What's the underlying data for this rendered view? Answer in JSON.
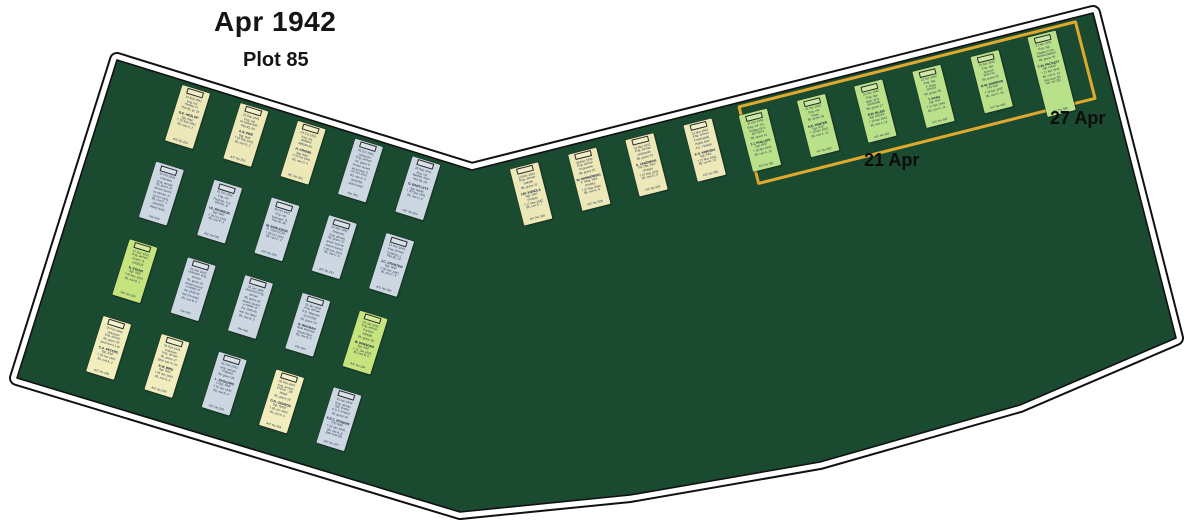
{
  "title": "Apr 1942",
  "subtitle": "Plot 85",
  "labels": {
    "apr21": "21 Apr",
    "apr27": "27 Apr"
  },
  "colors": {
    "felt": "#1a4a30",
    "outline": "#111111",
    "highlight_box": "#dfa92f",
    "card": {
      "cream": "#ece8b8",
      "blue": "#ccd7e2",
      "lime": "#c6e47d",
      "yellow": "#f1edbc",
      "green": "#b9e189"
    }
  },
  "left_grid": {
    "cards": [
      {
        "c": "cream",
        "t": [
          "15 Sep 1941",
          "Eng. mil.",
          "Heslop, D.",
          "Plot 85, gr. 19"
        ],
        "n": "G.E. HESLOP",
        "b": [
          "Sgt. RAF",
          "† 13 Sep 1941",
          "85, row D, 2"
        ],
        "r": "A/C No 251"
      },
      {
        "c": "cream",
        "t": [
          "15 Sep 1941",
          "Eng. mil.",
          "on burial RAF",
          "Plot 85, 60"
        ],
        "n": "A.N. PIKE",
        "b": [
          "Sgt. RAF",
          "† 15 Sep 1941",
          "85, row D, 3"
        ],
        "r": "A/C No 252"
      },
      {
        "c": "cream",
        "t": [
          "03 Oct 1941",
          "Eng. mil.",
          "detailed",
          "466594 RJ"
        ],
        "n": "H. CROWE",
        "b": [
          "Sgt. RAF",
          "† 03 Oct 1941",
          "85, row D, 4"
        ],
        "r": "A/C No 253"
      },
      {
        "c": "blue",
        "t": [
          "05 Oct 1941",
          "Unknown",
          "Eng. airman",
          "85, grave 8"
        ],
        "n": "",
        "b": [
          "shown buried",
          "as airman, d.",
          "05 Oct 1941",
          "85, row D, 5",
          "(possibly",
          "dated seal)"
        ],
        "r": "File 940"
      },
      {
        "c": "blue",
        "t": [
          "26 Sep 1941",
          "Eng. mil.",
          "Bartlett, Noel",
          "Plot 85, 09"
        ],
        "n": "G. BARTLETT",
        "b": [
          "Sgt. RAAF",
          "† 30 Sep 1941",
          "85, row D, 6"
        ],
        "r": "A/C No 254"
      },
      {
        "c": "blue",
        "t": [
          "12 Oct 1941",
          "Unknown",
          "Eng. airman",
          "85, grave 10"
        ],
        "n": "",
        "b": [
          "shown buried",
          "as airman, d.",
          "12 Oct 1941",
          "85, row C, 1",
          "(possibly",
          "dated seal)"
        ],
        "r": "File 940"
      },
      {
        "c": "blue",
        "t": [
          "21 Oct 1941",
          "Eng. mil.",
          "Pearson, C.E.",
          "Plot 85, 11"
        ],
        "n": "I.E. PEARSON",
        "b": [
          "Sgt. RAF",
          "† 20 Oct 1941",
          "85, row C, 3"
        ],
        "r": "A/C No 255"
      },
      {
        "c": "blue",
        "t": [
          "25 Oct 1941",
          "Eng. mil.",
          "Burleson, R.",
          "Plot 85, 98"
        ],
        "n": "W. BURLESON",
        "b": [
          "R. 2353 RCAF",
          "† 26 Oct 1941",
          "85, row C, 4"
        ],
        "r": "A/C No 256"
      },
      {
        "c": "blue",
        "t": [
          "02 Nov 1941",
          "Unknown",
          "Eng. airman",
          "85, grave 12"
        ],
        "n": "",
        "b": [
          "grave seal as",
          "shown buried",
          "† 06 Nov 1941",
          "85, row C, 5"
        ],
        "r": "A/C No 257"
      },
      {
        "c": "blue",
        "t": [
          "14 Dec 1941",
          "Eng. airman",
          "Cooksey, J.",
          "Plot 85, 13"
        ],
        "n": "J.C. CRANTON",
        "b": [
          "Sgt. RAF",
          "† 09 Dec 1941",
          "85, row C, 6"
        ],
        "r": "A/C No 260"
      },
      {
        "c": "lime",
        "t": [
          "17 Nov 1941",
          "Eng. airman",
          "Evans, G.",
          "1362520"
        ],
        "n": "N. EVANS",
        "b": [
          "Sgt. RAF",
          "† 09 Nov 1941",
          "85, row B, 1"
        ],
        "r": "A/C No 259"
      },
      {
        "c": "blue",
        "t": [
          "05 Jan 1942",
          "Unknown Eng.",
          "airman",
          "85, grave 22"
        ],
        "n": "",
        "b": [
          "shown buried",
          "a soldier of",
          "the 1939-45",
          "war (no date)",
          "85, row B, 2"
        ],
        "r": "File 940"
      },
      {
        "c": "blue",
        "t": [
          "02 Jan 1942",
          "Unknown Eng.",
          "airman",
          "85, grave 23"
        ],
        "n": "",
        "b": [
          "shown buried",
          "a soldier of",
          "the 1939-45",
          "war (no date)",
          "85, row B, 3"
        ],
        "r": "File 940"
      },
      {
        "c": "blue",
        "t": [
          "05 Jan 1942",
          "Eng. airman",
          "R.A. Wayman",
          "s/o 57258",
          "85, grave 24"
        ],
        "n": "N. WAYMAN",
        "b": [
          "Able Seaman",
          "Royal Navy",
          "85, row B, 4"
        ],
        "r": "File 940"
      },
      {
        "c": "lime",
        "t": [
          "02 Jan 1942",
          "Eng. airman",
          "Parsons",
          "930580",
          "85, grave 25"
        ],
        "n": "W. PARSONS",
        "b": [
          "Sgt. RAF",
          "† 01 Jan 1942",
          "85, row B, 6"
        ],
        "r": "A/C No 134"
      },
      {
        "c": "yellow",
        "t": [
          "05 Feb 1942",
          "Unknown",
          "Eng. airman",
          "85, grave 26",
          "(and war d.) as"
        ],
        "n": "C.A. PETERS",
        "b": [
          "Sgt. RAF",
          "† 28 Jan 1942",
          "85, row A, 2"
        ],
        "r": "A/C No 198"
      },
      {
        "c": "yellow",
        "t": [
          "05 Feb 1942",
          "Unknown",
          "Eng. airman",
          "85, grave 27",
          "(also war d.) as"
        ],
        "n": "E.W. BIRD",
        "b": [
          "Sgt. RAF",
          "† 26 Jan 1942",
          "85, row A, 3"
        ],
        "r": "A/C No 208"
      },
      {
        "c": "blue",
        "t": [
          "01 Feb 1942",
          "Eng. airman",
          "England",
          "85, grave 28"
        ],
        "n": "L. SAGGARS",
        "b": [
          "L/Sgt. RNF",
          "† 25 Jan 1942",
          "85, row A, 4"
        ],
        "r": "A/C No 218"
      },
      {
        "c": "yellow",
        "t": [
          "05 Feb 1942",
          "Eng. airman",
          "Church - SN",
          "RASF",
          "85, grave 29"
        ],
        "n": "G.N. GEORGE",
        "b": [
          "Sgt. RASF",
          "† 28 Jan 1942",
          "85, row A, 5"
        ],
        "r": "A/C No 228"
      },
      {
        "c": "blue",
        "t": [
          "15 Jan 1942",
          "Eng. airman",
          "Sgt. aviator",
          "C.S.T. 975007",
          "85, grave 30"
        ],
        "n": "E.E.C. ROGERS",
        "b": [
          "F/O RAF",
          "† 22 Jan 1942",
          "85, row A, 6",
          "(last seal 25)"
        ],
        "r": "A/C No 227"
      }
    ]
  },
  "middle_row": {
    "cards": [
      {
        "c": "cream",
        "t": [
          "14 Mar 1942",
          "Eng. airman",
          "Szkolik",
          "85, grave 31"
        ],
        "n": "J.M. KONDLA",
        "b": [
          "Sgt. RAF",
          "(Polish)",
          "† 17 Mar 1942",
          "85, row G, 7"
        ],
        "r": "A/C No 325"
      },
      {
        "c": "cream",
        "t": [
          "26 Mar 1942",
          "Eng. airman",
          "Piotrowski",
          "85, grave 32"
        ],
        "n": "W. WISNIOWSKI",
        "b": [
          "F. Serg. RAF",
          "(Polish)",
          "† 27 Mar 1942",
          "85, row G, 8"
        ],
        "r": "A/C No 326"
      },
      {
        "c": "cream",
        "t": [
          "31 Mar 1942",
          "Eng. airman",
          "Jackowski",
          "85, grave 33"
        ],
        "n": "S. JANOWIAK",
        "b": [
          "Plt. Offr. RAF",
          "(Polish)",
          "† 27 Mar 1942",
          "85, row G, 9"
        ],
        "r": "A/C No 329"
      },
      {
        "c": "cream",
        "t": [
          "31 Mar 1942",
          "Eng. airman",
          "Frankowski",
          "Polish RAF",
          "A.C. 794940"
        ],
        "n": "K.S. HORODA",
        "b": [
          "Sgt. PAF",
          "† 27 Mar 1942",
          "85, row G, 10"
        ],
        "r": "A/C No 330"
      }
    ]
  },
  "highlight_row": {
    "cards": [
      {
        "c": "green",
        "t": [
          "21 Apr 1942",
          "Eng. mil. S.L.",
          "Phillips RFS",
          "AO RAFV",
          "85, grave 21"
        ],
        "n": "T.J. PHILLIPS",
        "b": [
          "Sgt. RAF",
          "† 19 Apr 1942",
          "85, row A, 12"
        ],
        "r": "A/C No 361"
      },
      {
        "c": "green",
        "t": [
          "21 Apr 1942",
          "Eng. mil.",
          "Pilots",
          "85, grave 26"
        ],
        "n": "H.E. WINTER",
        "b": [
          "Sgt. RAF",
          "† 19 Apr 1942",
          "85, row A, 13"
        ],
        "r": "A/C No 362"
      },
      {
        "c": "green",
        "t": [
          "21 Apr 1942",
          "Eng. Sgt.",
          "Blair, W.H.",
          "Windmills",
          "85, grave 27"
        ],
        "n": "R.W. BLAIR",
        "b": [
          "Sgt. RNZAF",
          "† 19 Apr 1942",
          "85, row A, 14"
        ],
        "r": "A/C No 363"
      },
      {
        "c": "green",
        "t": [
          "21 Apr 1942",
          "Eng. Sgt.",
          "F. Ryan",
          "RFNVF",
          "85, grave 28"
        ],
        "n": "T. RYAN",
        "b": [
          "Sgt. RAF",
          "† 17 Apr 1942",
          "85, row G, 14"
        ],
        "r": "A/C No 364"
      },
      {
        "c": "green",
        "t": [
          "21 Apr 1942",
          "Eng. Sgt.",
          "Barrow",
          "W.R.F.N.",
          "85, grave 29"
        ],
        "n": "R.W. BARROW",
        "b": [
          "F/O RAF",
          "† 15 Apr 1942",
          "85, row G, 15"
        ],
        "r": "A/C No 365"
      },
      {
        "c": "green",
        "tall": true,
        "t": [
          "27 Apr 1942",
          "Eng. Sgt.",
          "Packet, Fram",
          "Newfoundland",
          "85, grave 30"
        ],
        "n": "C.W. PACKETT",
        "b": [
          "Sgt. RAAF",
          "† 27 Apr 1942",
          "85, row D, 14",
          "(last seal 25)",
          "(ref. No 25)"
        ],
        "r": "A/C No 366"
      }
    ]
  }
}
